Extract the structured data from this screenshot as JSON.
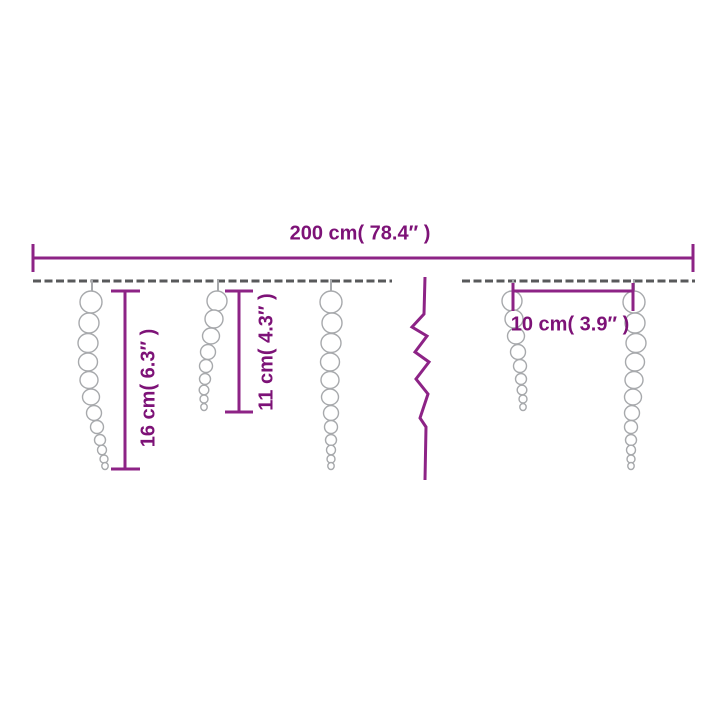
{
  "diagram": {
    "type": "product-dimension-diagram",
    "subject": "icicle string lights on a wire",
    "dimensions": {
      "total_width": {
        "label": "200 cm( 78.4″ )",
        "value_cm": 200,
        "value_in": 78.4,
        "orientation": "horizontal"
      },
      "long_icicle": {
        "label": "16 cm( 6.3″ )",
        "value_cm": 16,
        "value_in": 6.3,
        "orientation": "vertical"
      },
      "short_icicle": {
        "label": "11 cm( 4.3″ )",
        "value_cm": 11,
        "value_in": 4.3,
        "orientation": "vertical"
      },
      "spacing": {
        "label": "10 cm( 3.9″ )",
        "value_cm": 10,
        "value_in": 3.9,
        "orientation": "horizontal"
      }
    },
    "icicle_count_shown": 5,
    "colors": {
      "dimension_lines": "#8d2386",
      "dimension_text": "#7d1277",
      "wire": "#58595b",
      "icicle_outline": "#a7a9ac",
      "background": "#ffffff"
    }
  }
}
